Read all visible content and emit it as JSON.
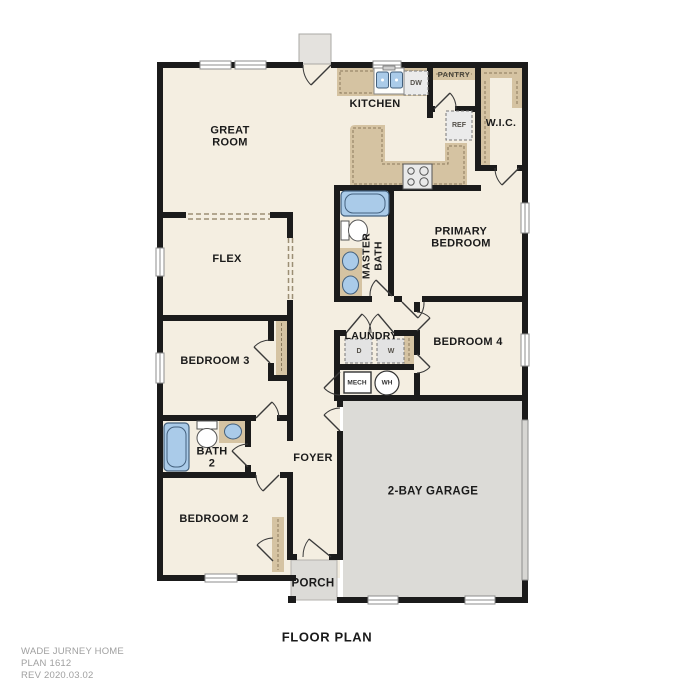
{
  "plan": {
    "title": "FLOOR PLAN",
    "footer": {
      "brand": "WADE JURNEY HOME",
      "plan_number": "PLAN 1612",
      "revision": "REV 2020.03.02"
    }
  },
  "rooms": {
    "great_room": "GREAT ROOM",
    "kitchen": "KITCHEN",
    "pantry": "PANTRY",
    "wic": "W.I.C.",
    "primary_bedroom": "PRIMARY BEDROOM",
    "master_bath": "MASTER BATH",
    "flex": "FLEX",
    "bedroom3": "BEDROOM 3",
    "laundry": "LAUNDRY",
    "bedroom4": "BEDROOM 4",
    "bath2": "BATH 2",
    "foyer": "FOYER",
    "bedroom2": "BEDROOM 2",
    "garage": "2-BAY GARAGE",
    "porch": "PORCH"
  },
  "appliances": {
    "refrigerator": "REF",
    "dishwasher": "DW",
    "dryer": "D",
    "washer": "W",
    "mechanical": "MECH",
    "water_heater": "WH"
  },
  "colors": {
    "floor": "#f4eee1",
    "wall": "#1b1b1b",
    "cabinet": "#d5c3a2",
    "cabinet_line": "#8a7a5c",
    "fixture_blue": "#aacbe9",
    "garage_floor": "#dcdbd7",
    "appliance_gray": "#ebebeb",
    "label_text": "#1a1a1a",
    "footer_text": "#a0a0a0"
  }
}
